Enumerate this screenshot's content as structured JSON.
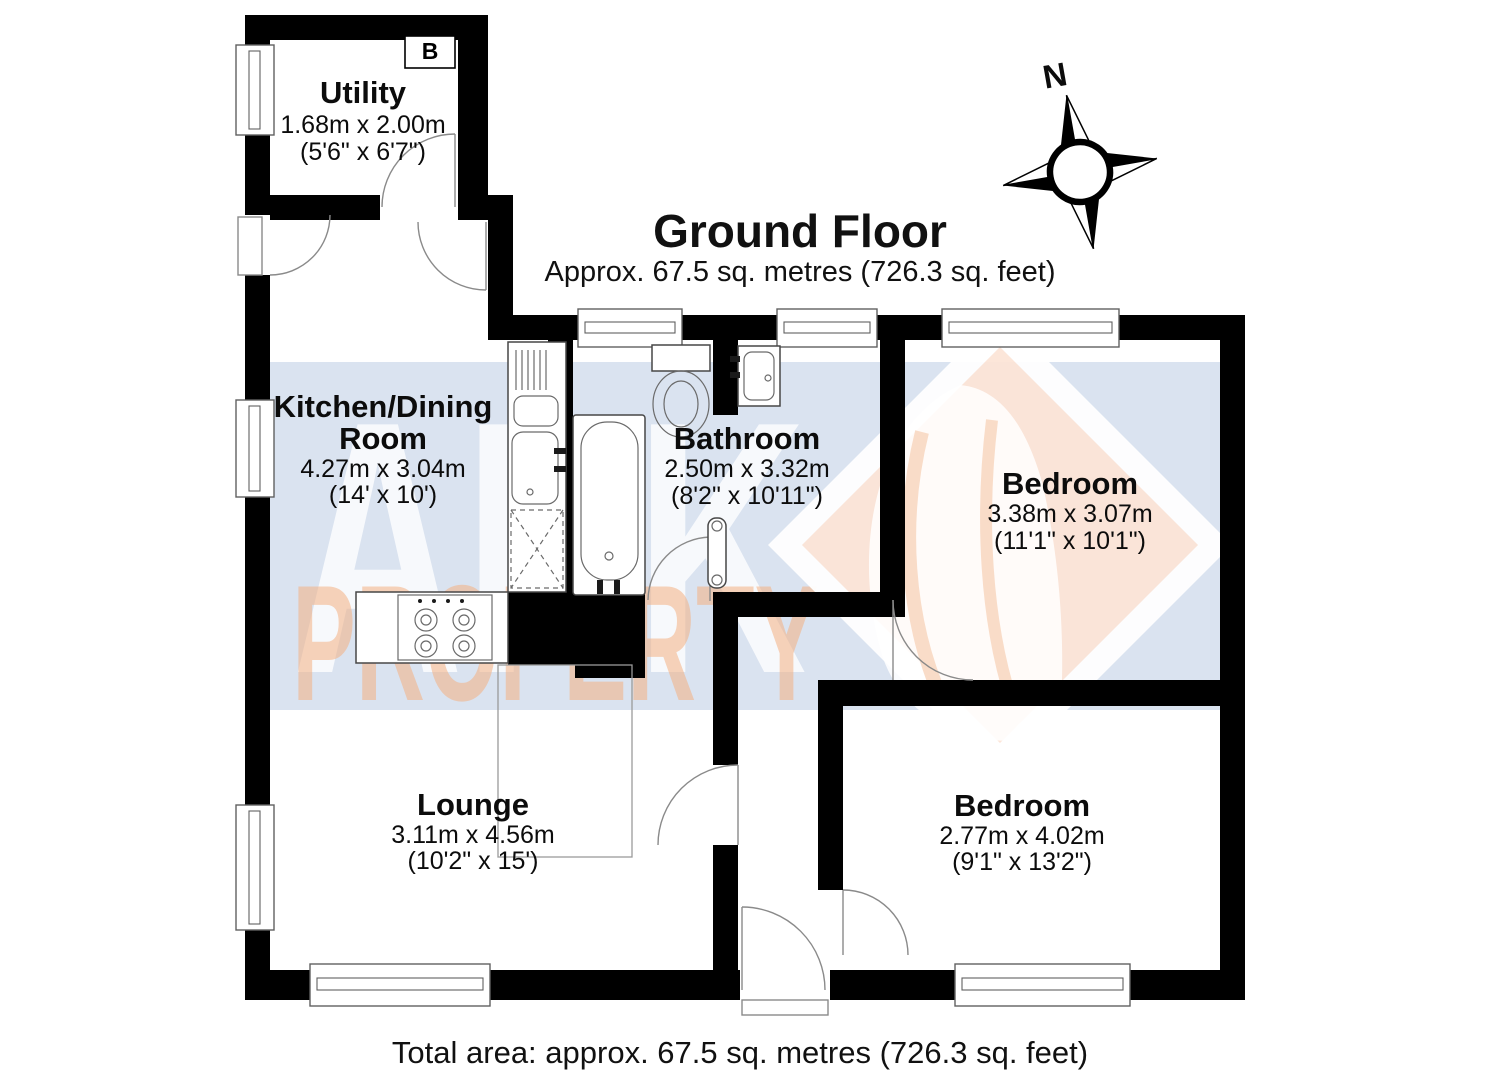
{
  "header": {
    "title": "Ground Floor",
    "subtitle": "Approx. 67.5 sq. metres (726.3 sq. feet)"
  },
  "footer": {
    "total_area": "Total area: approx. 67.5 sq. metres (726.3 sq. feet)"
  },
  "compass": {
    "north": "N"
  },
  "annotations": {
    "boiler": "B"
  },
  "watermark": {
    "brand_top": "ARK",
    "brand_bottom": "PROPERTY"
  },
  "rooms": {
    "utility": {
      "name": "Utility",
      "metric": "1.68m x 2.00m",
      "imperial": "(5'6\" x 6'7\")"
    },
    "kitchen": {
      "name_line1": "Kitchen/Dining",
      "name_line2": "Room",
      "metric": "4.27m x 3.04m",
      "imperial": "(14' x 10')"
    },
    "bathroom": {
      "name": "Bathroom",
      "metric": "2.50m x 3.32m",
      "imperial": "(8'2\" x 10'11\")"
    },
    "bedroom1": {
      "name": "Bedroom",
      "metric": "3.38m x 3.07m",
      "imperial": "(11'1\" x 10'1\")"
    },
    "bedroom2": {
      "name": "Bedroom",
      "metric": "2.77m x 4.02m",
      "imperial": "(9'1\" x 13'2\")"
    },
    "lounge": {
      "name": "Lounge",
      "metric": "3.11m x 4.56m",
      "imperial": "(10'2\" x 15')"
    }
  },
  "colors": {
    "wall": "#000000",
    "band": "#dae3f0",
    "diamond_fill": "#fce5d7",
    "watermark_orange": "#f4b183",
    "watermark_white": "#ffffff"
  }
}
